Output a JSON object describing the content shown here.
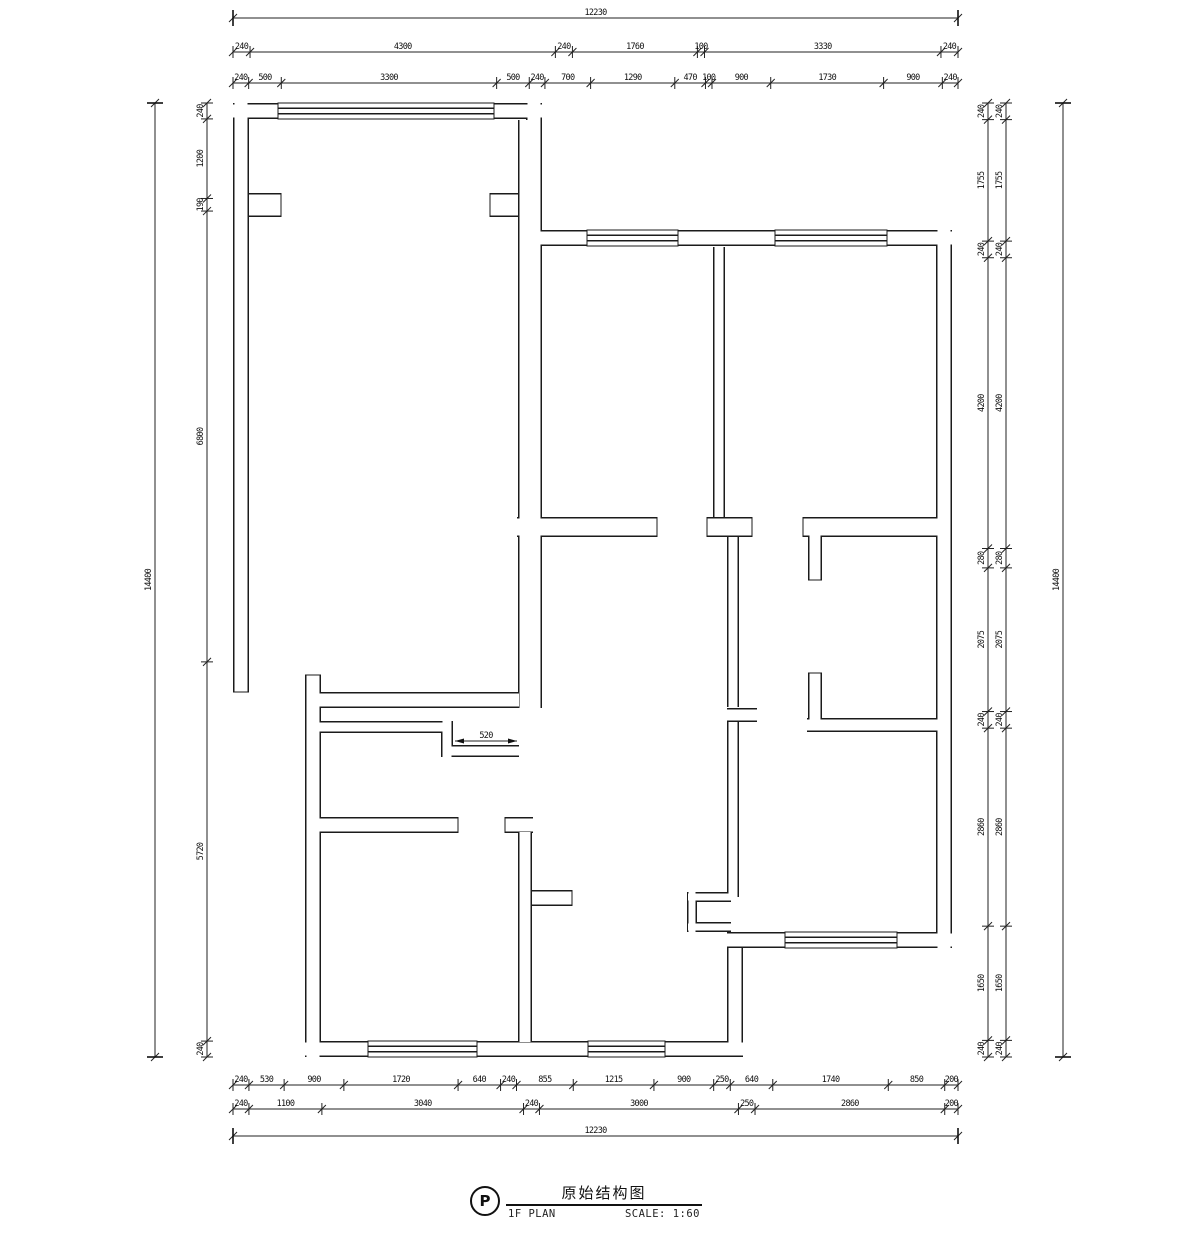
{
  "title_block": {
    "tag": "P",
    "title": "原始结构图",
    "subtitle": "1F PLAN",
    "scale_label": "SCALE: 1:60"
  },
  "colors": {
    "line": "#1b1b1b",
    "background": "#ffffff"
  },
  "drawing": {
    "dimensions": [
      {
        "id": "top-overall",
        "orient": "h",
        "line": 18,
        "start": 233,
        "end": 958,
        "style": "bar",
        "values": [
          "12230"
        ]
      },
      {
        "id": "top-row-mid",
        "orient": "h",
        "line": 52,
        "start": 233,
        "end": 958,
        "values": [
          "240",
          "4300",
          "240",
          "1760",
          "100",
          "3330",
          "240"
        ]
      },
      {
        "id": "top-row-inner",
        "orient": "h",
        "line": 83,
        "start": 233,
        "end": 958,
        "values": [
          "240",
          "500",
          "3300",
          "500",
          "240",
          "700",
          "1290",
          "470",
          "100",
          "900",
          "1730",
          "900",
          "240"
        ]
      },
      {
        "id": "bottom-row-inner",
        "orient": "h",
        "line": 1085,
        "start": 233,
        "end": 958,
        "values": [
          "240",
          "530",
          "900",
          "1720",
          "640",
          "240",
          "855",
          "1215",
          "900",
          "250",
          "640",
          "1740",
          "850",
          "200"
        ]
      },
      {
        "id": "bottom-row-mid",
        "orient": "h",
        "line": 1109,
        "start": 233,
        "end": 958,
        "values": [
          "240",
          "1100",
          "3040",
          "240",
          "3000",
          "250",
          "2860",
          "200"
        ]
      },
      {
        "id": "bottom-overall",
        "orient": "h",
        "line": 1136,
        "start": 233,
        "end": 958,
        "style": "bar",
        "values": [
          "12230"
        ]
      },
      {
        "id": "left-inner",
        "orient": "v",
        "line": 207,
        "start": 103,
        "end": 1057,
        "values": [
          "240",
          "1200",
          "190",
          "6800",
          "5720",
          "240"
        ]
      },
      {
        "id": "left-overall",
        "orient": "v",
        "line": 155,
        "start": 103,
        "end": 1057,
        "style": "bar",
        "values": [
          "14400"
        ]
      },
      {
        "id": "right-inner-a",
        "orient": "v",
        "line": 988,
        "start": 103,
        "end": 1057,
        "values": [
          "240",
          "1755",
          "240",
          "4200",
          "280",
          "2075",
          "240",
          "2860",
          "1650",
          "240"
        ]
      },
      {
        "id": "right-inner-b",
        "orient": "v",
        "line": 1006,
        "start": 103,
        "end": 1057,
        "values": [
          "240",
          "1755",
          "240",
          "4200",
          "280",
          "2075",
          "240",
          "2860",
          "1650",
          "240"
        ]
      },
      {
        "id": "right-overall",
        "orient": "v",
        "line": 1063,
        "start": 103,
        "end": 1057,
        "style": "bar",
        "values": [
          "14400"
        ]
      },
      {
        "id": "interior-door",
        "orient": "h",
        "line": 741,
        "start": 455,
        "end": 517,
        "style": "arrow",
        "values": [
          "520"
        ]
      }
    ]
  },
  "plan": {
    "walls": [
      [
        233,
        111,
        278,
        111,
        16
      ],
      [
        494,
        111,
        542,
        111,
        16
      ],
      [
        241,
        103,
        241,
        692,
        16
      ],
      [
        534,
        103,
        534,
        246,
        16
      ],
      [
        534,
        238,
        587,
        238,
        16
      ],
      [
        678,
        238,
        775,
        238,
        16
      ],
      [
        887,
        238,
        952,
        238,
        16
      ],
      [
        944,
        230,
        944,
        948,
        16
      ],
      [
        727,
        940,
        785,
        940,
        16
      ],
      [
        897,
        940,
        952,
        940,
        16
      ],
      [
        688,
        897,
        731,
        897,
        10
      ],
      [
        692,
        892,
        692,
        932,
        10
      ],
      [
        688,
        927,
        731,
        927,
        10
      ],
      [
        313,
        675,
        313,
        1057,
        16
      ],
      [
        305,
        1049,
        368,
        1049,
        16
      ],
      [
        477,
        1049,
        588,
        1049,
        16
      ],
      [
        665,
        1049,
        743,
        1049,
        16
      ],
      [
        735,
        948,
        735,
        1049,
        16
      ],
      [
        530,
        120,
        530,
        708,
        24
      ],
      [
        249,
        205,
        281,
        205,
        24
      ],
      [
        490,
        205,
        518,
        205,
        24
      ],
      [
        517,
        527,
        657,
        527,
        20
      ],
      [
        707,
        527,
        752,
        527,
        20
      ],
      [
        803,
        527,
        944,
        527,
        20
      ],
      [
        719,
        247,
        719,
        517,
        12
      ],
      [
        733,
        537,
        733,
        707,
        12
      ],
      [
        727,
        715,
        757,
        715,
        14
      ],
      [
        733,
        722,
        733,
        897,
        12
      ],
      [
        815,
        535,
        815,
        580,
        14
      ],
      [
        815,
        673,
        815,
        728,
        14
      ],
      [
        807,
        725,
        944,
        725,
        14
      ],
      [
        313,
        700,
        519,
        700,
        16
      ],
      [
        313,
        727,
        447,
        727,
        12
      ],
      [
        447,
        721,
        447,
        757,
        12
      ],
      [
        447,
        751,
        519,
        751,
        12
      ],
      [
        313,
        825,
        458,
        825,
        16
      ],
      [
        505,
        825,
        533,
        825,
        16
      ],
      [
        525,
        832,
        525,
        1042,
        14
      ],
      [
        532,
        898,
        572,
        898,
        16
      ]
    ],
    "caps": [
      [
        233,
        692,
        249,
        692
      ],
      [
        305,
        675,
        321,
        675
      ],
      [
        657,
        517,
        657,
        537
      ],
      [
        707,
        517,
        707,
        537
      ],
      [
        752,
        517,
        752,
        537
      ],
      [
        803,
        517,
        803,
        537
      ],
      [
        458,
        817,
        458,
        833
      ],
      [
        505,
        817,
        505,
        833
      ],
      [
        808,
        580,
        822,
        580
      ],
      [
        808,
        673,
        822,
        673
      ],
      [
        572,
        890,
        572,
        906
      ],
      [
        281,
        193,
        281,
        217
      ],
      [
        490,
        193,
        490,
        217
      ]
    ],
    "windows": [
      [
        278,
        103,
        216,
        16
      ],
      [
        587,
        230,
        91,
        16
      ],
      [
        775,
        230,
        112,
        16
      ],
      [
        785,
        932,
        112,
        16
      ],
      [
        368,
        1041,
        109,
        16
      ],
      [
        588,
        1041,
        77,
        16
      ]
    ]
  }
}
